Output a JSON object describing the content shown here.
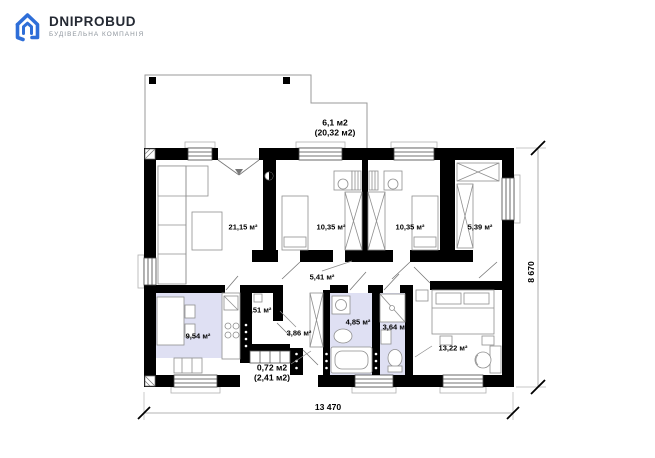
{
  "logo": {
    "title": "DNIPROBUD",
    "subtitle": "БУДІВЕЛЬНА КОМПАНІЯ"
  },
  "plan": {
    "rooms": [
      {
        "id": "terrace",
        "line1": "6,1 м2",
        "line2": "(20,32 м2)"
      },
      {
        "id": "living",
        "label": "21,15 м²"
      },
      {
        "id": "bedroom-1",
        "label": "10,35 м²"
      },
      {
        "id": "bedroom-2",
        "label": "10,35 м²"
      },
      {
        "id": "wardrobe",
        "label": "5,39 м²"
      },
      {
        "id": "hallway",
        "label": "5,41 м²"
      },
      {
        "id": "kitchen",
        "label": "9,54 м²"
      },
      {
        "id": "pantry",
        "label": "2,51 м²"
      },
      {
        "id": "entry-hall",
        "label": "3,86 м²"
      },
      {
        "id": "bathroom",
        "label": "4,85 м²"
      },
      {
        "id": "wc",
        "label": "3,64 м²"
      },
      {
        "id": "bedroom-3",
        "label": "13,22 м²"
      },
      {
        "id": "porch",
        "line1": "0,72 м2",
        "line2": "(2,41 м2)"
      }
    ],
    "dimensions": {
      "width": "13 470",
      "height": "8 670"
    }
  },
  "colors": {
    "wall": "#000000",
    "floor_highlight": "#dfe0f3",
    "logo_blue": "#2e6ed8",
    "thin_line": "#8c8c8c"
  }
}
